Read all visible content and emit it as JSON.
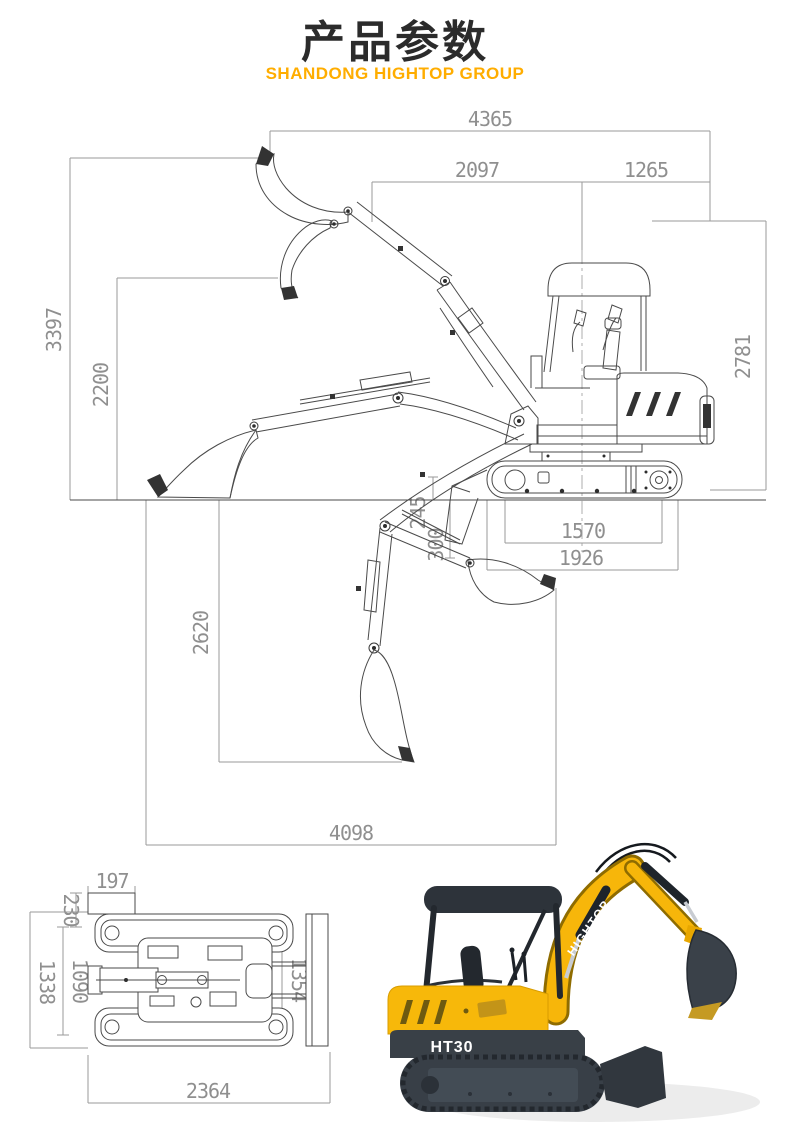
{
  "header": {
    "title": "产品参数",
    "subtitle": "SHANDONG HIGHTOP GROUP"
  },
  "side_view": {
    "dims": {
      "d4365": "4365",
      "d2097": "2097",
      "d1265": "1265",
      "d3397": "3397",
      "d2200": "2200",
      "d2781": "2781",
      "d245": "245",
      "d300": "300",
      "d1570": "1570",
      "d1926": "1926",
      "d2620": "2620",
      "d4098": "4098"
    }
  },
  "plan_view": {
    "dims": {
      "d197": "197",
      "d230": "230",
      "d1338": "1338",
      "d1090": "1090",
      "d1354": "1354",
      "d2364": "2364"
    }
  },
  "photo": {
    "brand": "HIGHTOP",
    "model": "HT30"
  },
  "colors": {
    "accent": "#FFAD00",
    "title_text": "#2B2B2B",
    "dim_line": "#9A9A9A",
    "dim_text": "#8F8F8F",
    "drawing_line": "#4A4A4A",
    "body_yellow": "#F6B600",
    "dark_steel": "#394047",
    "shadow": "#ECECEC"
  }
}
